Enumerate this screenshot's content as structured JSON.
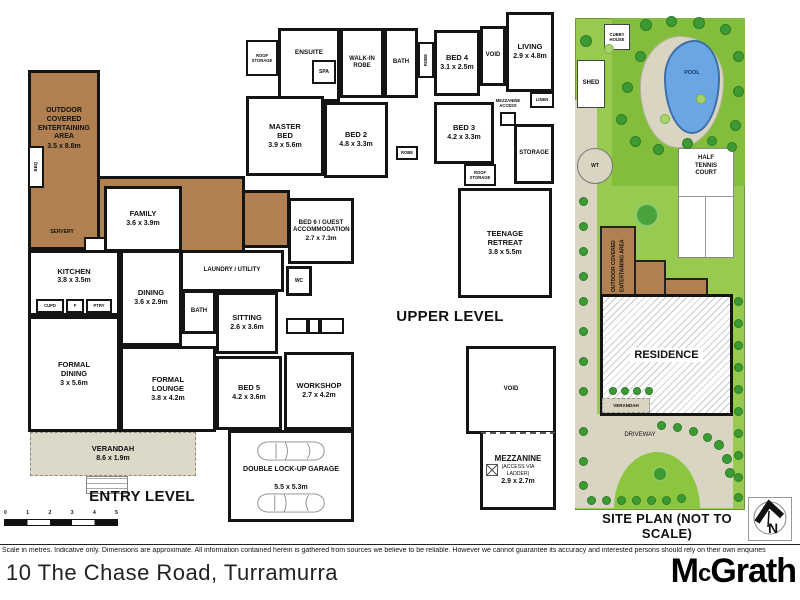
{
  "colors": {
    "deck_brown": "#b08050",
    "paving": "#d9d5c2",
    "verandah_grey": "#dcd9c8",
    "wall": "#141414",
    "lawn": "#97ca4e",
    "lawn_dark": "#83bd3c",
    "tree_dark": "#3c9a33",
    "pool_blue": "#6aa6e4"
  },
  "entry": {
    "level_label": "ENTRY LEVEL",
    "rooms": {
      "outdoor": {
        "name": "OUTDOOR COVERED ENTERTAINING AREA",
        "dims": "3.5 x 8.8m"
      },
      "bbq": {
        "name": "BBQ"
      },
      "servery": {
        "name": "SERVERY"
      },
      "family": {
        "name": "FAMILY",
        "dims": "3.6 x 3.9m"
      },
      "kitchen": {
        "name": "KITCHEN",
        "dims": "3.8 x 3.5m"
      },
      "cupd": {
        "name": "CUPD"
      },
      "fridge": {
        "name": "F"
      },
      "pantry": {
        "name": "PTRY"
      },
      "dining": {
        "name": "DINING",
        "dims": "3.6 x 2.9m"
      },
      "bath": {
        "name": "BATH"
      },
      "laundry": {
        "name": "LAUNDRY / UTILITY"
      },
      "wc": {
        "name": "WC"
      },
      "bed6": {
        "name": "BED 6 / GUEST ACCOMMODATION",
        "dims": "2.7 x 7.3m"
      },
      "sitting": {
        "name": "SITTING",
        "dims": "2.6 x 3.6m"
      },
      "formal_dining": {
        "name": "FORMAL DINING",
        "dims": "3 x 5.6m"
      },
      "formal_lounge": {
        "name": "FORMAL LOUNGE",
        "dims": "3.8 x 4.2m"
      },
      "bed5": {
        "name": "BED 5",
        "dims": "4.2 x 3.6m"
      },
      "workshop": {
        "name": "WORKSHOP",
        "dims": "2.7 x 4.2m"
      },
      "verandah": {
        "name": "VERANDAH",
        "dims": "8.6 x 1.9m"
      },
      "garage": {
        "name": "DOUBLE LOCK-UP GARAGE",
        "dims": "5.5 x 5.3m"
      }
    }
  },
  "upper": {
    "level_label": "UPPER LEVEL",
    "rooms": {
      "roof_storage_left": {
        "name": "ROOF STORAGE"
      },
      "ensuite": {
        "name": "ENSUITE"
      },
      "spa": {
        "name": "SPA"
      },
      "walk_in_robe": {
        "name": "WALK-IN ROBE"
      },
      "bath": {
        "name": "BATH"
      },
      "robe_a": {
        "name": "ROBE"
      },
      "robe_b": {
        "name": "ROBE"
      },
      "bed4": {
        "name": "BED 4",
        "dims": "3.1 x 2.5m"
      },
      "void_top": {
        "name": "VOID"
      },
      "living": {
        "name": "LIVING",
        "dims": "2.9 x 4.8m"
      },
      "linen": {
        "name": "LINEN"
      },
      "master": {
        "name": "MASTER BED",
        "dims": "3.9 x 5.6m"
      },
      "bed2": {
        "name": "BED 2",
        "dims": "4.8 x 3.3m"
      },
      "bed3": {
        "name": "BED 3",
        "dims": "4.2 x 3.3m"
      },
      "mezzanine_access": {
        "name": "MEZZANINE ACCESS"
      },
      "storage": {
        "name": "STORAGE"
      },
      "roof_storage_right": {
        "name": "ROOF STORAGE"
      },
      "teenage": {
        "name": "TEENAGE RETREAT",
        "dims": "3.8 x 5.5m"
      },
      "void_lower": {
        "name": "VOID"
      },
      "mezzanine": {
        "name": "MEZZANINE",
        "note": "(ACCESS VIA LADDER)",
        "dims": "2.9 x 2.7m"
      }
    }
  },
  "site": {
    "label": "SITE PLAN (NOT TO SCALE)",
    "items": {
      "cubby": {
        "name": "CUBBY HOUSE"
      },
      "shed": {
        "name": "SHED"
      },
      "pool": {
        "name": "POOL"
      },
      "wt": {
        "name": "WT"
      },
      "tennis": {
        "name": "HALF TENNIS COURT"
      },
      "oce": {
        "name": "OUTDOOR COVERED ENTERTAINING AREA"
      },
      "residence": {
        "name": "RESIDENCE"
      },
      "verandah": {
        "name": "VERANDAH"
      },
      "driveway": {
        "name": "DRIVEWAY"
      },
      "north": {
        "name": "N"
      }
    }
  },
  "scale_bar": {
    "ticks": [
      "0",
      "1",
      "2",
      "3",
      "4",
      "5"
    ]
  },
  "footer": {
    "disclaimer": "Scale in metres. Indicative only. Dimensions are approximate. All information contained herein is gathered from sources we believe to be reliable. However we cannot guarantee its accuracy and interested persons should rely on their own enquiries",
    "address": "10 The Chase Road, Turramurra",
    "brand_m": "M",
    "brand_c": "c",
    "brand_rest": "Grath"
  }
}
